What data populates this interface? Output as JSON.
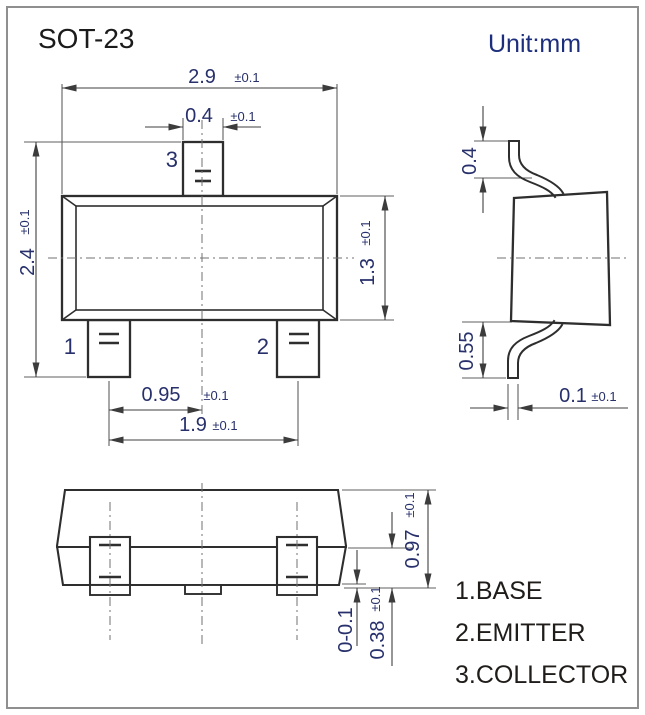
{
  "title": "SOT-23",
  "unit_label": "Unit:mm",
  "front_view": {
    "pin1_num": "1",
    "pin2_num": "2",
    "pin3_num": "3",
    "dim_body_width": {
      "v": "2.9",
      "t": "±0.1"
    },
    "dim_tab_width": {
      "v": "0.4",
      "t": "±0.1"
    },
    "dim_total_height": {
      "v": "2.4",
      "t": "±0.1"
    },
    "dim_body_height": {
      "v": "1.3",
      "t": "±0.1"
    },
    "dim_half_pitch": {
      "v": "0.95",
      "t": "±0.1"
    },
    "dim_pitch": {
      "v": "1.9",
      "t": "±0.1"
    }
  },
  "side_view": {
    "dim_top_lead": {
      "v": "0.4"
    },
    "dim_bottom_lead": {
      "v": "0.55"
    },
    "dim_lead_thickness": {
      "v": "0.1",
      "t": "±0.1"
    }
  },
  "bottom_view": {
    "dim_height": {
      "v": "0.97",
      "t": "±0.1"
    },
    "dim_standoff": {
      "v": "0-0.1"
    },
    "dim_foot": {
      "v": "0.38",
      "t": "±0.1"
    }
  },
  "pin_functions": [
    "1.BASE",
    "2.EMITTER",
    "3.COLLECTOR"
  ],
  "colors": {
    "ink": "#2e2e2e",
    "dim_text": "#27306b",
    "unit_text": "#1d2f7c",
    "list_text": "#1f1c1a"
  }
}
